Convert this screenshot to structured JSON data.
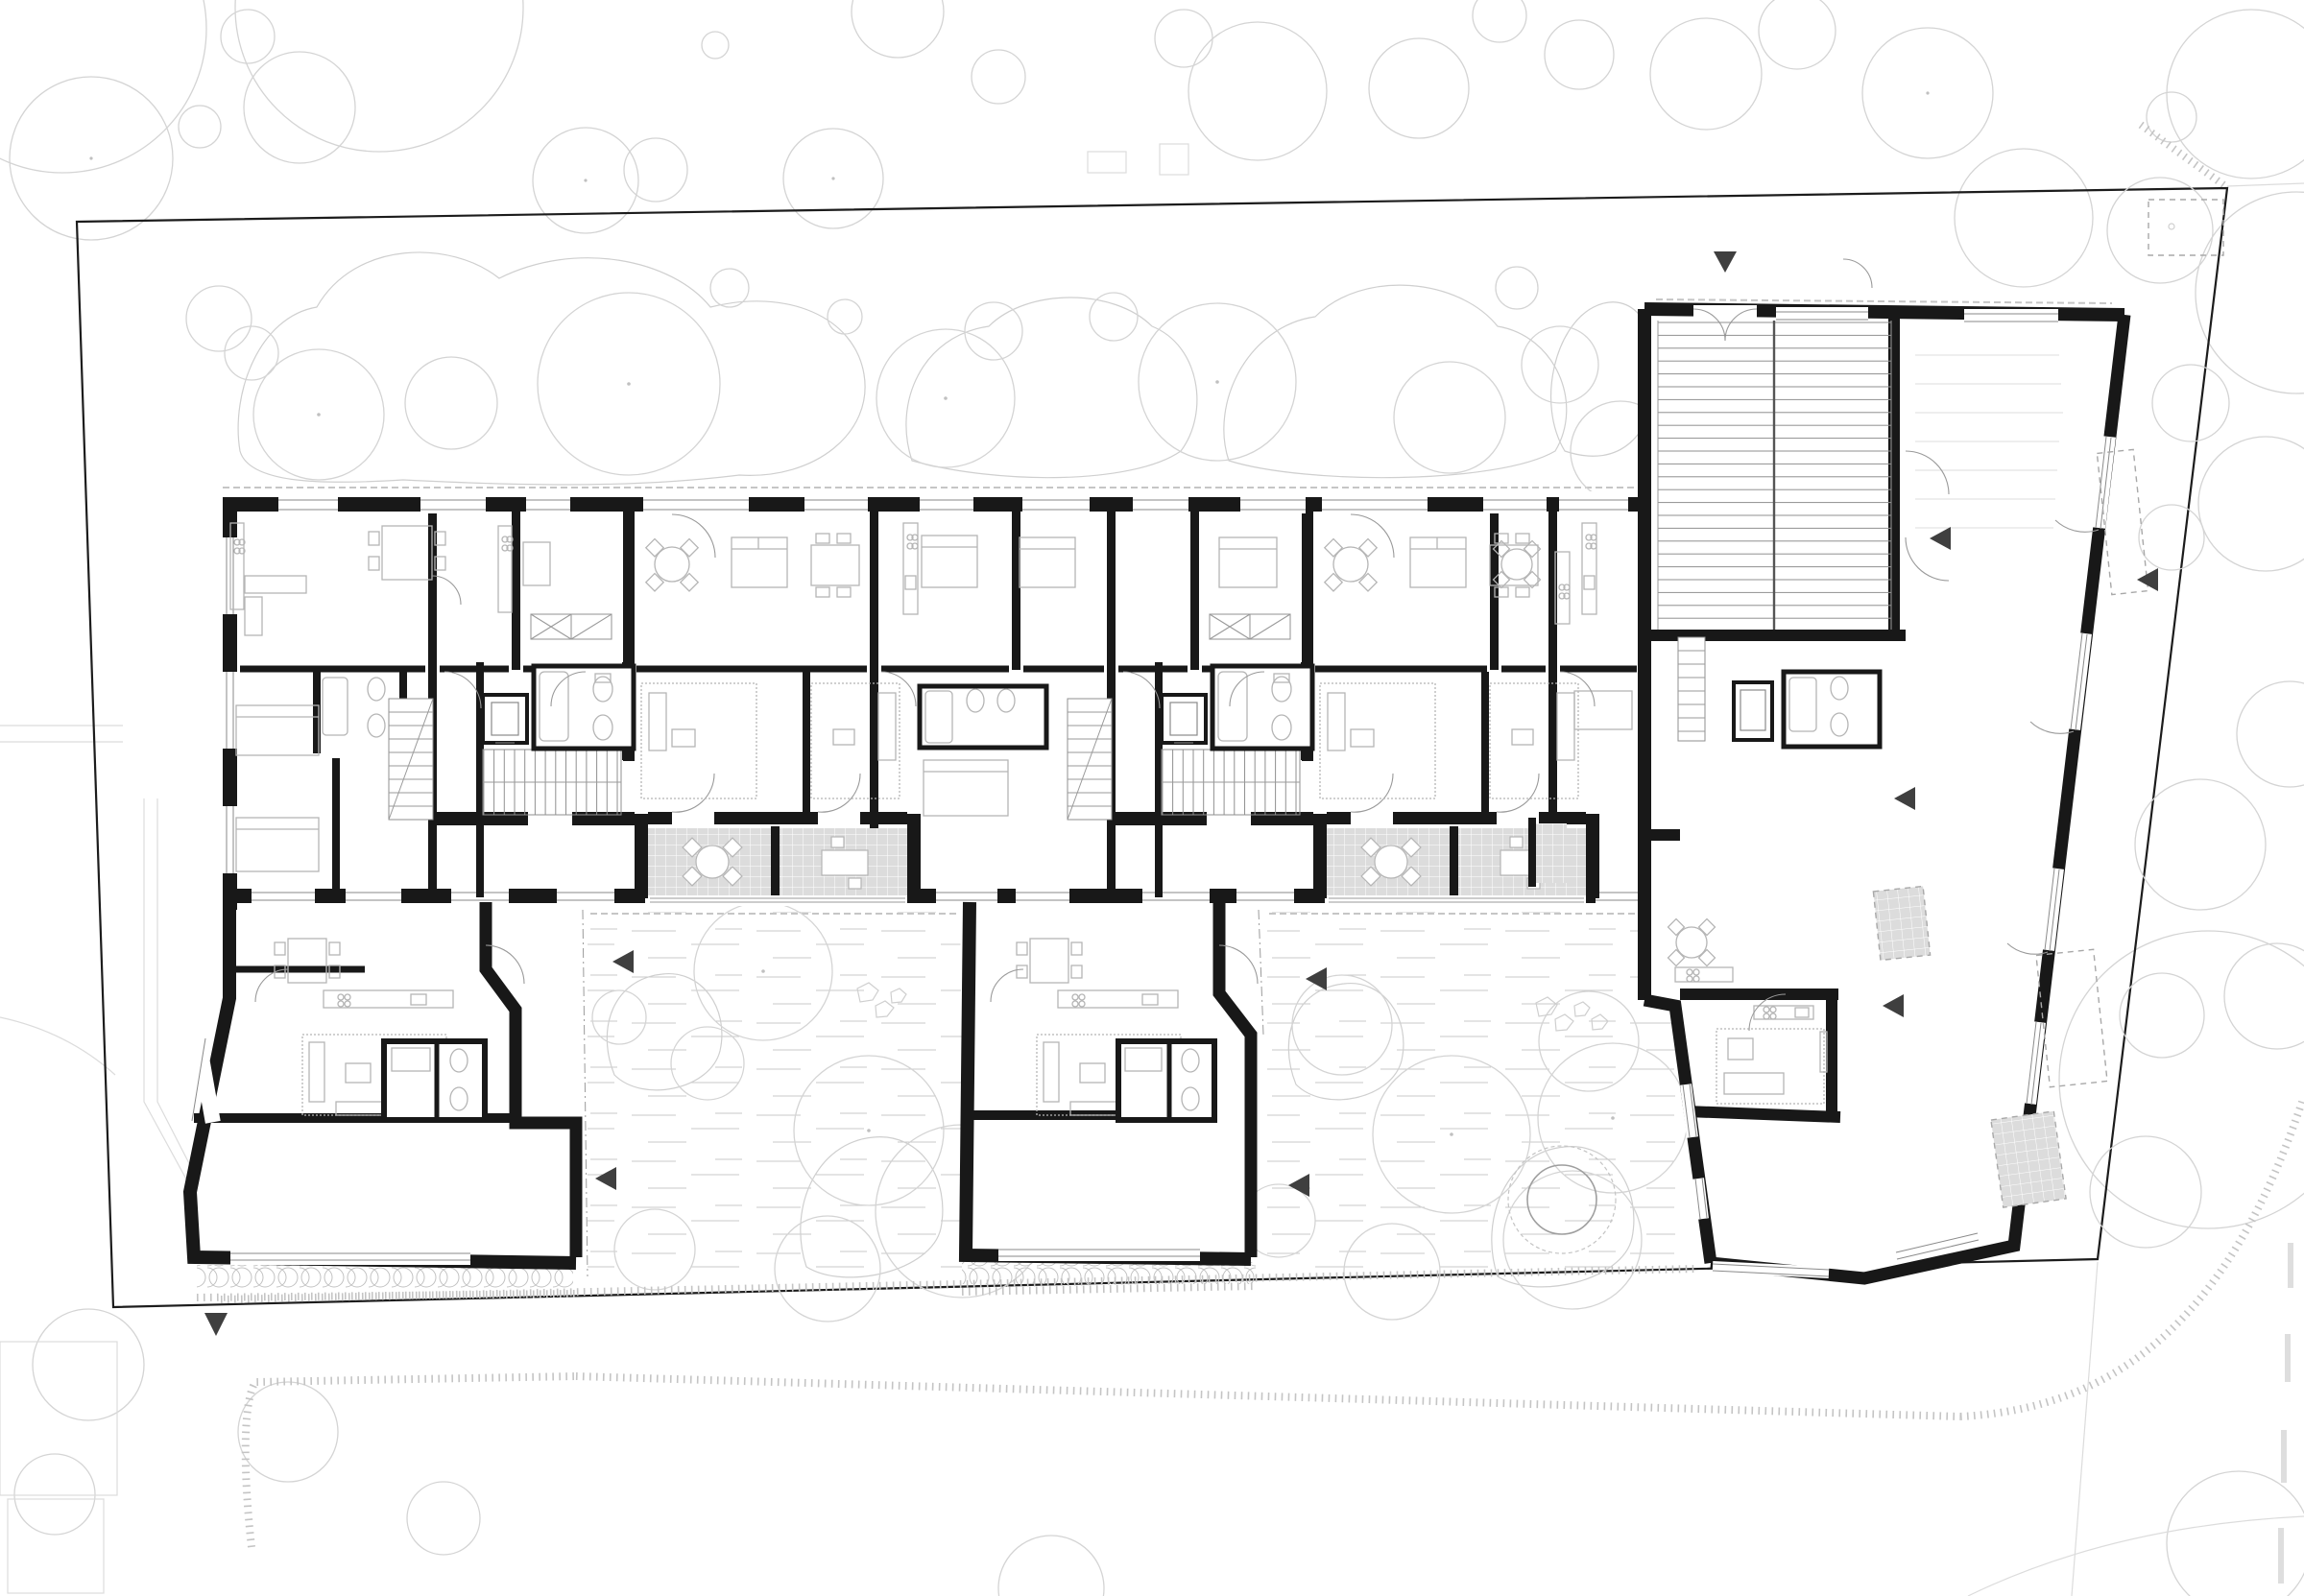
{
  "document": {
    "type": "architectural-floor-plan",
    "view": "ground floor / site plan",
    "visible_text": "none",
    "drawing_style": "black poché walls on white, light gray landscape linework"
  },
  "palette": {
    "background": "#ffffff",
    "walls": "#181818",
    "site_boundary": "#1c1c1c",
    "context": "#dcdcdc",
    "vegetation": "#cfcfcf",
    "tree": "#d4d4d4",
    "furniture": "#b5b5b5",
    "doors": "#9a9a9a",
    "glazing": "#8a8a8a",
    "balcony_fill": "#dcdcdc",
    "balcony_grid": "#ffffff",
    "stair_treads": "#8f8f8f",
    "grass": "#c9c9c9",
    "entrance_arrow": "#3f3f3f",
    "pond": "#9e9e9e"
  },
  "inventory": {
    "site_boundary_shape": "irregular trapezoid",
    "building_wings": 3,
    "linear_block_units_band": 1,
    "stair_cores": 3,
    "elevators": 2,
    "balconies_tiled": 2,
    "balcony_divider_walls": 2,
    "courtyards": 2,
    "garden_ramp_double_flight": 1,
    "entrance_arrows": 10,
    "arrow_directions": [
      "down",
      "left",
      "left",
      "left",
      "left",
      "left",
      "left",
      "left",
      "left",
      "up"
    ],
    "garden_trees_approx": 46,
    "shrub_patches_approx": 10,
    "stone_clusters": 2,
    "pond_circle": 1,
    "dashed_parking_rects": 3,
    "paved_patios": 3,
    "hedge_strips": 3,
    "street_curb_bands": 3
  },
  "icons": {
    "entrance-arrow-icon": "small filled triangle",
    "tree-icon": "thin circle with center dot",
    "closet-icon": "rectangle with diagonal cross",
    "stair-icon": "hatched flight with break line",
    "elevator-icon": "nested rectangles",
    "hob-icon": "four small circles",
    "balcony-icon": "gray tiled grid rectangle"
  }
}
